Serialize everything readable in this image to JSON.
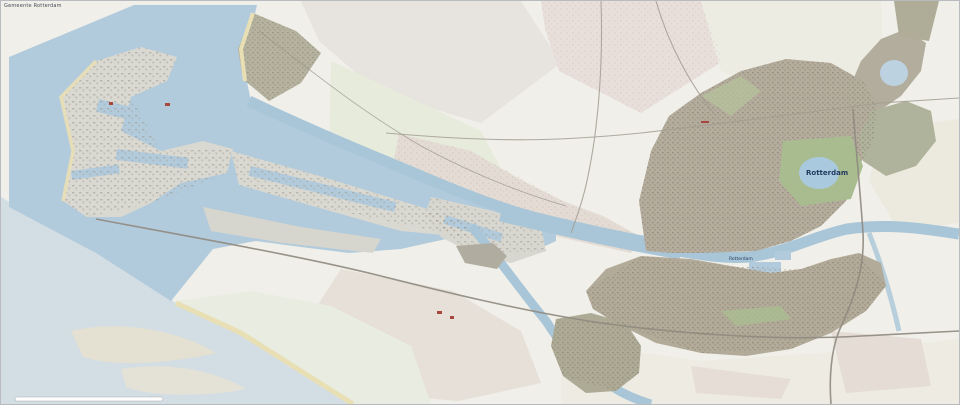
{
  "map": {
    "attribution": "Gemeente Rotterdam",
    "labels": {
      "city": {
        "text": "Rotterdam"
      },
      "city_secondary": {
        "text": "Rotterdam"
      }
    },
    "scale_bar": {
      "present": "true"
    },
    "colors": {
      "land_outside": "#f0efe9",
      "sea_outside": "#d3dde4",
      "water_municipal": "#b2cbdc",
      "water_river": "#a9c6d8",
      "lake_blue": "#a9cade",
      "port_land": "#d9d8d1",
      "urban_saturated": "#b4ac9c",
      "urban_olive": "#adab96",
      "park_green": "#a9bc90",
      "sand": "#e9dfb5",
      "outside_town": "#e3dbd4",
      "outside_green": "#e7ebdc",
      "outside_pink": "#e9dfda",
      "road": "#a39d92",
      "highway": "#8f8a80",
      "rail": "#9a958f",
      "red_accent": "#a8483c",
      "label_navy": "#223a5e",
      "scalebar_fill": "#ffffff"
    }
  }
}
